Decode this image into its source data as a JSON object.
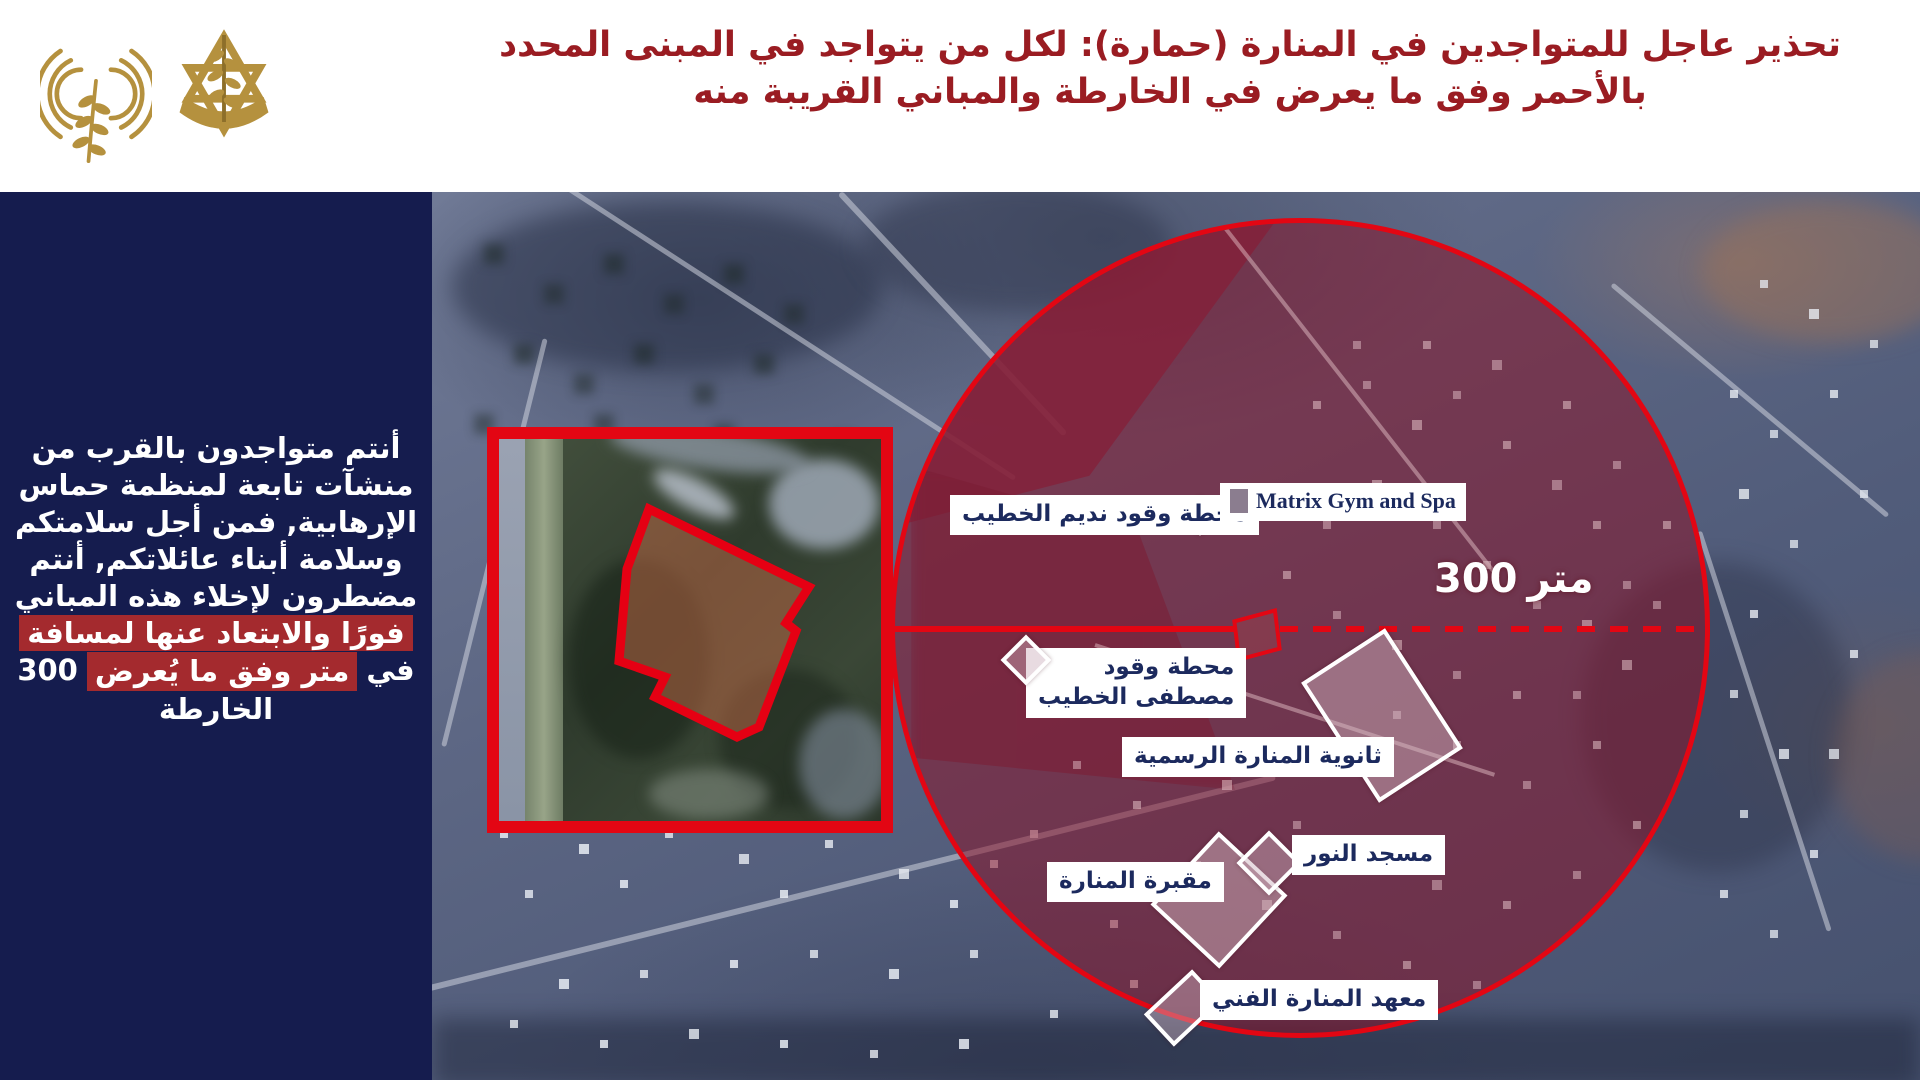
{
  "header": {
    "title_line1": "تحذير عاجل للمتواجدين في المنارة (حمارة): لكل من يتواجد في المبنى المحدد",
    "title_line2": "بالأحمر وفق ما يعرض في الخارطة والمباني القريبة منه"
  },
  "icons": {
    "broadcast_logo": "radio-waves-olive-branch",
    "idf_emblem": "star-of-david-sword-olive-branch"
  },
  "sidebar": {
    "line1": "أنتم متواجدون بالقرب من",
    "line2": "منشآت تابعة لمنظمة حماس",
    "line3": "الإرهابية, فمن أجل سلامتكم",
    "line4": "وسلامة أبناء عائلاتكم, أنتم",
    "line5": "مضطرون لإخلاء هذه المباني",
    "line6": "فورًا والابتعاد عنها لمسافة",
    "line7_num": "300",
    "line7_hl": "متر وفق ما يُعرض",
    "line7_end": "في",
    "line8": "الخارطة"
  },
  "map": {
    "labels": {
      "nadim": "محطة وقود نديم الخطيب",
      "matrix": "Matrix Gym and Spa",
      "mustafa_1": "محطة وقود",
      "mustafa_2": "مصطفى الخطيب",
      "school": "ثانوية المنارة الرسمية",
      "mosque": "مسجد النور",
      "cemetery": "مقبرة المنارة",
      "institute": "معهد المنارة الفني"
    },
    "distance_num": "300",
    "distance_unit": "متر"
  },
  "colors": {
    "accent_red": "#e30613",
    "title_red": "#9a1c22",
    "sidebar_navy": "#151c4e",
    "label_navy": "#1c2a5e",
    "highlight_red": "#a42a2e",
    "gold": "#b5913e",
    "circle_tint": "#8c1226"
  }
}
